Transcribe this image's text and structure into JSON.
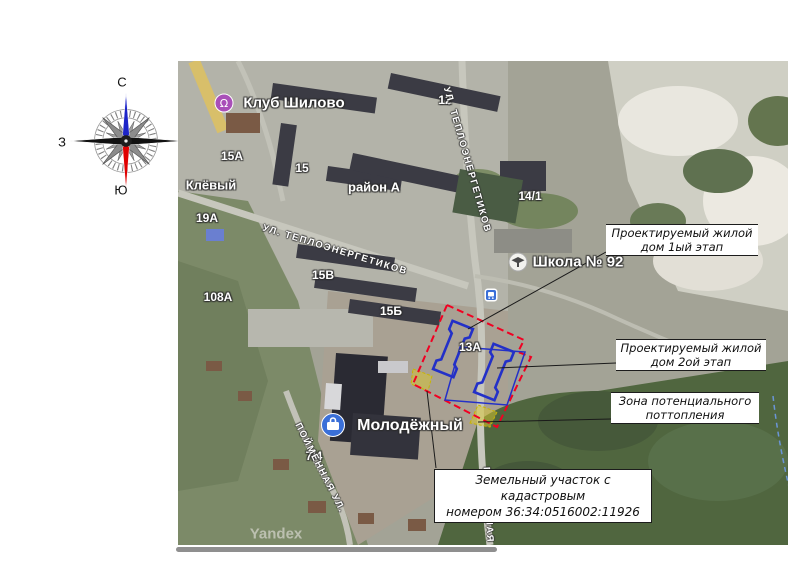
{
  "compass": {
    "north": "С",
    "south": "Ю",
    "west": "З",
    "east": "В"
  },
  "map": {
    "watermark": "Yandex",
    "places": {
      "club": "Клуб Шилово",
      "school": "Школа № 92",
      "mall": "Молодёжный"
    },
    "building_numbers": {
      "b15a": "15А",
      "b15": "15",
      "b12": "12",
      "b14_1": "14/1",
      "b19a": "19А",
      "b108a": "108А",
      "b15v": "15В",
      "b15b": "15Б",
      "b13a": "13А",
      "b7_4": "7/4"
    },
    "areas": {
      "klevy": "Клёвый",
      "district": "район А"
    },
    "streets": {
      "teploenergetikov": "УЛ. ТЕПЛОЭНЕРГЕТИКОВ",
      "poymennaya": "ПОЙМЕННАЯ УЛ.",
      "poymennaya_short": "ПОЙМЕННАЯ"
    }
  },
  "callouts": {
    "stage1": {
      "line1": "Проектируемый жилой",
      "line2": "дом 1ый этап"
    },
    "stage2": {
      "line1": "Проектируемый жилой",
      "line2": "дом 2ой этап"
    },
    "flood": {
      "line1": "Зона потенциального",
      "line2": "поттопления"
    },
    "cadastral": {
      "line1": "Земельный участок с кадастровым",
      "line2": "номером 36:34:0516002:11926"
    }
  },
  "colors": {
    "parcel_boundary": "#f10022",
    "projected_building_outline": "#2330c8",
    "flood_zone_fill": "#d9c72e",
    "leader_line": "#1a1a1a",
    "club_icon": "#a94fb8",
    "school_icon_bg": "#f2f2ee",
    "mall_icon": "#3a6fd8",
    "transport_icon": "#3a6fd8",
    "compass_north": "#1c24c8",
    "compass_south": "#e00000",
    "compass_eastwest": "#111111"
  }
}
